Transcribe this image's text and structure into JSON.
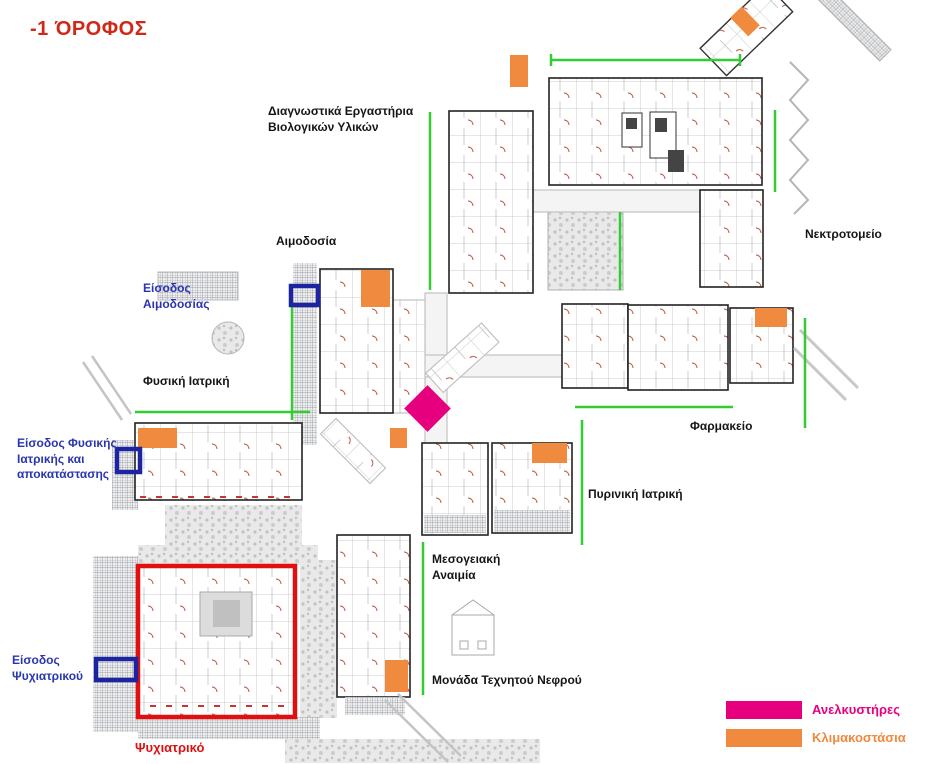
{
  "page": {
    "title": "-1 ΌΡΟΦΟΣ"
  },
  "labels": {
    "diagnostic_labs": "Διαγνωστικά Εργαστήρια\nΒιολογικών Υλικών",
    "blood_donation": "Αιμοδοσία",
    "blood_donation_entrance": "Είσοδος\nΑιμοδοσίας",
    "physical_medicine": "Φυσική Ιατρική",
    "physical_medicine_entrance": "Είσοδος Φυσικής\nΙατρικής και\nαποκατάστασης",
    "morgue": "Νεκτροτομείο",
    "pharmacy": "Φαρμακείο",
    "nuclear_medicine": "Πυρινική Ιατρική",
    "mediterranean_anemia": "Μεσογειακή\nΑναιμία",
    "artificial_kidney_unit": "Μονάδα Τεχνητού Νεφρού",
    "psychiatric_entrance": "Είσοδος\nΨυχιατρικού",
    "psychiatric": "Ψυχιατρικό"
  },
  "legend": {
    "elevators": {
      "label": "Ανελκυστήρες",
      "color": "#e6007e"
    },
    "staircases": {
      "label": "Κλιμακοστάσια",
      "color": "#f08a3e"
    }
  },
  "colors": {
    "title_red": "#d02818",
    "entrance_blue": "#2a35b0",
    "entrance_outline": "#1c24a0",
    "psychiatric_red": "#e01010",
    "path_green": "#33cc33"
  }
}
